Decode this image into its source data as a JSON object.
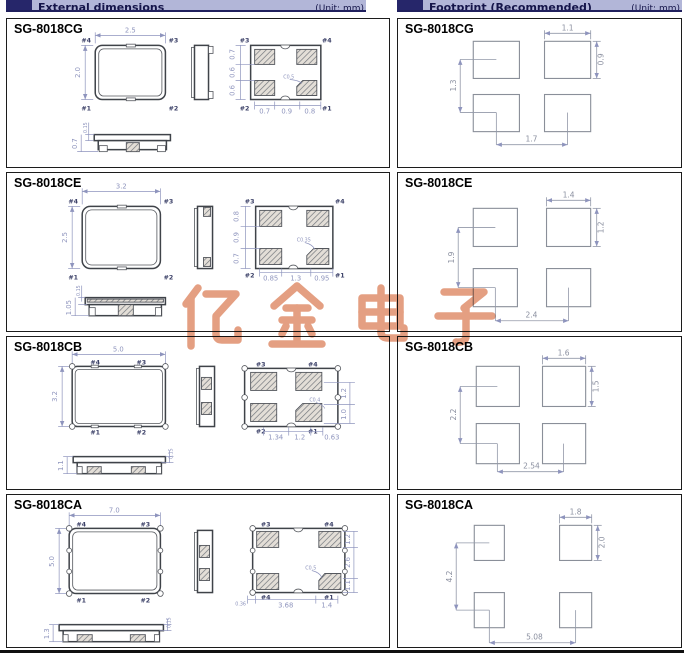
{
  "header": {
    "left_title": "External dimensions",
    "left_unit": "(Unit: mm)",
    "right_title": "Footprint (Recommended)",
    "right_unit": "(Unit: mm)"
  },
  "watermark": {
    "text": "亿金电子",
    "color": "#dd8763"
  },
  "ext": [
    {
      "model": "SG-8018CG",
      "dim_w": "2.5",
      "dim_h": "2.0",
      "pins_top": {
        "tl": "#4",
        "tr": "#3",
        "bl": "#1",
        "br": "#2"
      },
      "pins_pad": {
        "tl": "#3",
        "tr": "#4",
        "bl": "#2",
        "br": "#1"
      },
      "pad_v": [
        "0.7",
        "0.6",
        "0.6"
      ],
      "pad_h": [
        "0.7",
        "0.9",
        "0.8"
      ],
      "chamfer": "C0.5",
      "profile_h": "0.7",
      "profile_t": "0.15"
    },
    {
      "model": "SG-8018CE",
      "dim_w": "3.2",
      "dim_h": "2.5",
      "pins_top": {
        "tl": "#4",
        "tr": "#3",
        "bl": "#1",
        "br": "#2"
      },
      "pins_pad": {
        "tl": "#3",
        "tr": "#4",
        "bl": "#2",
        "br": "#1"
      },
      "pad_v": [
        "0.8",
        "0.9",
        "0.7"
      ],
      "pad_h": [
        "0.85",
        "1.3",
        "0.95"
      ],
      "chamfer": "C0.35",
      "profile_h": "1.05",
      "profile_t": "0.15"
    },
    {
      "model": "SG-8018CB",
      "dim_w": "5.0",
      "dim_h": "3.2",
      "pins_top": {
        "tl": "#4",
        "tr": "#3",
        "bl": "#1",
        "br": "#2"
      },
      "pins_pad": {
        "tl": "#3",
        "tr": "#4",
        "bl": "#2",
        "br": "#1"
      },
      "pad_v": [
        "1.2",
        "1.0"
      ],
      "pad_h": [
        "1.34",
        "1.2",
        "0.63"
      ],
      "chamfer": "C0.4",
      "profile_h": "1.1",
      "profile_t": "0.15"
    },
    {
      "model": "SG-8018CA",
      "dim_w": "7.0",
      "dim_h": "5.0",
      "pins_top": {
        "tl": "#4",
        "tr": "#3",
        "bl": "#1",
        "br": "#2"
      },
      "pins_pad": {
        "tl": "#3",
        "tr": "#4",
        "bl": "#4",
        "br": "#1"
      },
      "pad_v": [
        "1.2",
        "2.6",
        "1.1"
      ],
      "pad_h": [
        "0.36",
        "3.68",
        "1.4"
      ],
      "chamfer": "C0.5",
      "profile_h": "1.3",
      "profile_t": "0.15"
    }
  ],
  "fp": [
    {
      "model": "SG-8018CG",
      "pad_w": "1.1",
      "pad_h": "0.9",
      "v_pitch": "1.3",
      "h_pitch": "1.7"
    },
    {
      "model": "SG-8018CE",
      "pad_w": "1.4",
      "pad_h": "1.2",
      "v_pitch": "1.9",
      "h_pitch": "2.4"
    },
    {
      "model": "SG-8018CB",
      "pad_w": "1.6",
      "pad_h": "1.5",
      "v_pitch": "2.2",
      "h_pitch": "2.54"
    },
    {
      "model": "SG-8018CA",
      "pad_w": "1.8",
      "pad_h": "2.0",
      "v_pitch": "4.2",
      "h_pitch": "5.08"
    }
  ]
}
